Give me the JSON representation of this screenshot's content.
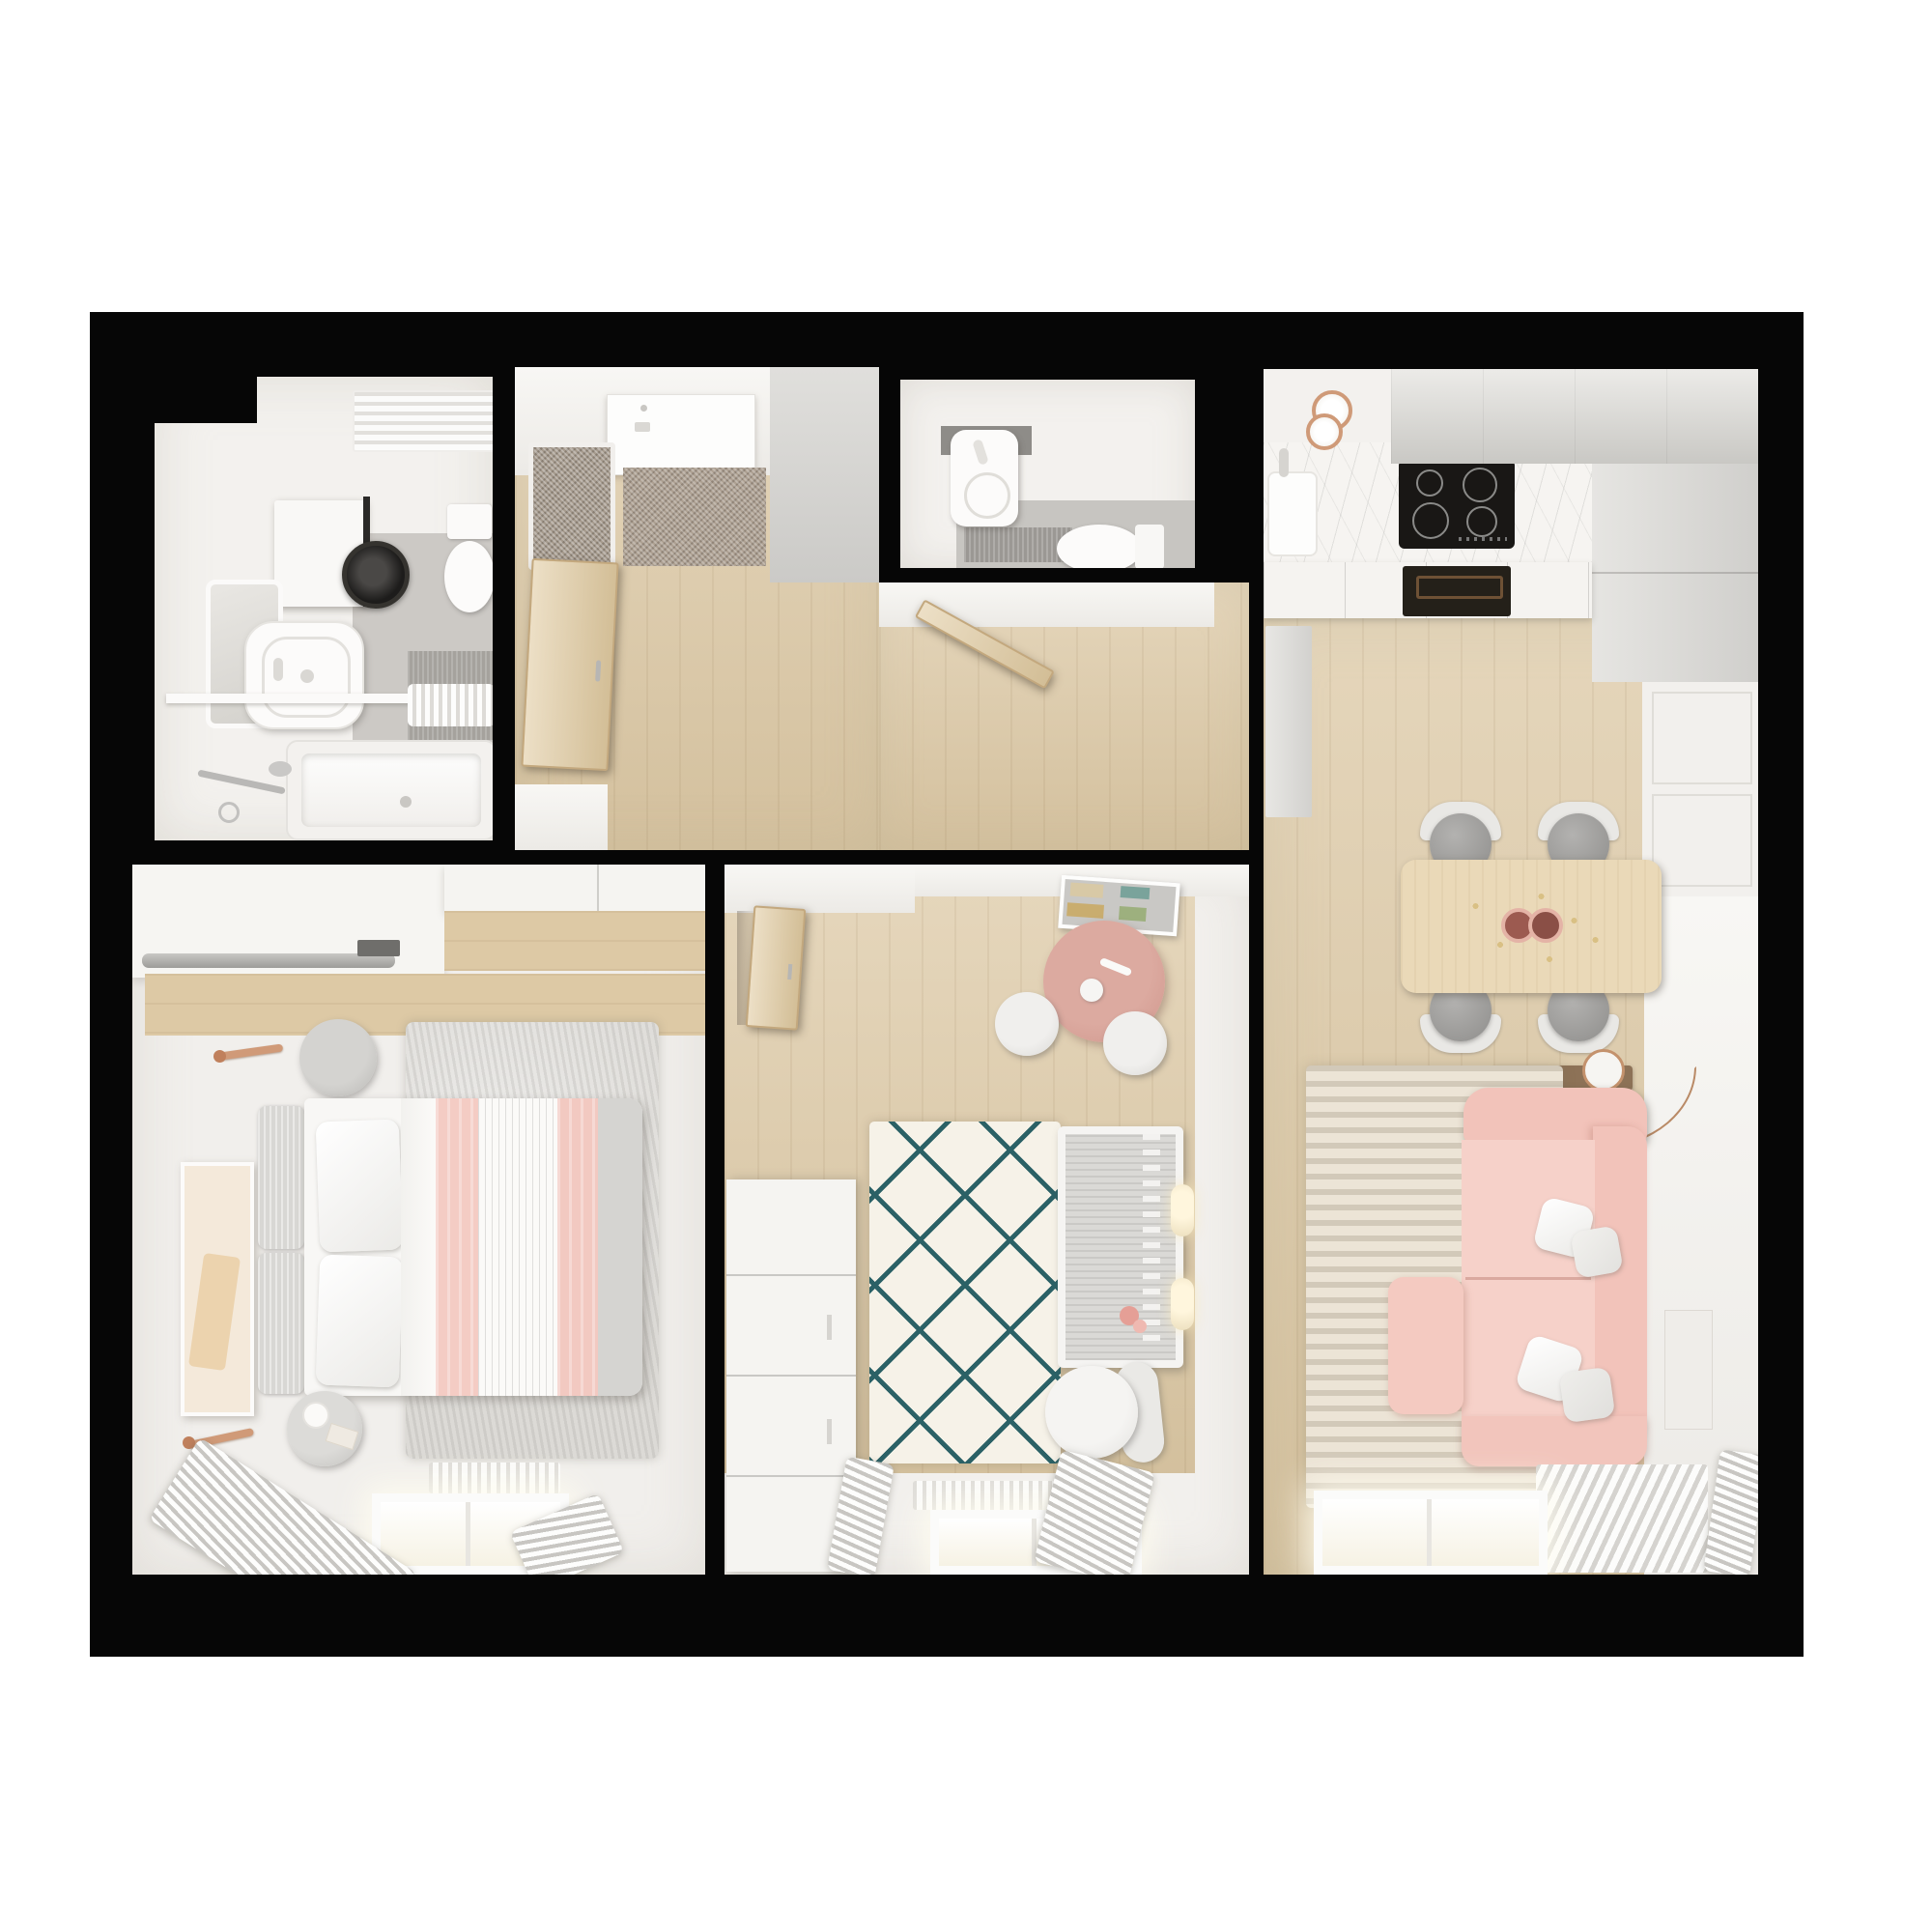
{
  "scene": {
    "type": "3d-floor-plan-top-down-render",
    "description_visible_text": "",
    "background": "#ffffff",
    "wall_color": "#060606"
  },
  "palette": {
    "walls_black": "#060606",
    "room_white": "#f3f1ee",
    "wood_floor": "#dcc8a4",
    "doormat_taupe": "#ada092",
    "marble_counter": "#f6f4f1",
    "grey_cabinet": "#d0cfcc",
    "hob_black": "#191715",
    "sofa_pink": "#f2c3ba",
    "blanket_pink": "#f4ccc4",
    "kids_table_pink": "#d7a096",
    "rug_cream": "#f6f2e8",
    "rug_teal_lines": "#2b6166",
    "rug_beige_stripe": "#ece4d6",
    "rug_grey": "#dcdad6",
    "wood_door": "#e0caa0",
    "copper_accent": "#d09a78"
  },
  "rooms": [
    {
      "id": "bathroom",
      "name": "Bathroom",
      "furniture": [
        "towel-radiator",
        "washing-machine-cabinet",
        "washing-machine",
        "toilet",
        "mirror",
        "vessel-sink",
        "shelf",
        "towels",
        "bathtub",
        "shower-faucet"
      ]
    },
    {
      "id": "hall",
      "name": "Entry hall",
      "furniture": [
        "entrance-door",
        "doormat",
        "pin-board",
        "open-wood-door",
        "wall-segment"
      ]
    },
    {
      "id": "corridor",
      "name": "Corridor",
      "furniture": [
        "wc-door"
      ]
    },
    {
      "id": "wc",
      "name": "WC",
      "furniture": [
        "wall-hung-sink",
        "toilet",
        "floor-mat"
      ]
    },
    {
      "id": "kitchen-living",
      "name": "Kitchen and living room",
      "furniture": [
        "ceiling-lamps",
        "upper-cabinets",
        "marble-counter",
        "kitchen-sink",
        "induction-hob",
        "base-cabinets",
        "oven",
        "tall-unit",
        "dining-table",
        "dining-chairs",
        "console",
        "floor-lamp",
        "striped-rug",
        "pink-corner-sofa",
        "pillows",
        "wall-art",
        "radiator",
        "window",
        "curtain"
      ]
    },
    {
      "id": "bedroom",
      "name": "Bedroom",
      "furniture": [
        "open-wardrobe-rail",
        "wardrobe-cabinet",
        "grey-rug",
        "pouf",
        "wall-sconce",
        "picture-frame",
        "double-bed",
        "pillows",
        "pink-striped-duvet",
        "side-table",
        "table-lamp",
        "radiator",
        "window",
        "curtains"
      ]
    },
    {
      "id": "nursery",
      "name": "Nursery",
      "furniture": [
        "open-wood-door",
        "book-shelf",
        "pink-kids-table",
        "stools",
        "dresser",
        "diamond-rug",
        "crib",
        "doll",
        "wall-lamps",
        "armchair",
        "radiator",
        "window",
        "curtains"
      ]
    }
  ]
}
